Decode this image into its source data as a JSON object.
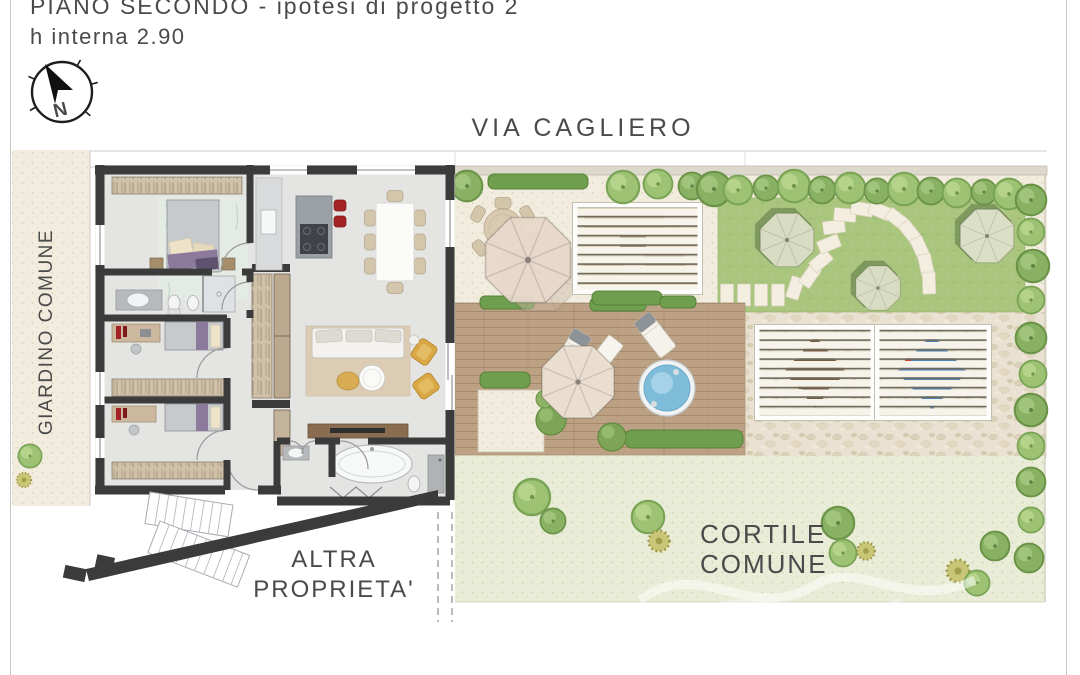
{
  "header": {
    "title": "PIANO SECONDO - ipotesi di progetto 2",
    "subtitle": "h interna 2.90"
  },
  "compass": {
    "north_label": "N"
  },
  "labels": {
    "street": "VIA CAGLIERO",
    "common_garden": "GIARDINO COMUNE",
    "other_property": [
      "ALTRA",
      "PROPRIETA'"
    ],
    "common_courtyard": [
      "CORTILE",
      "COMUNE"
    ]
  },
  "colors": {
    "wall": "#3b3b3b",
    "floor": "#e4e4e2",
    "deck_wood": "#bda184",
    "lawn_green": "#a9c57e",
    "fine_gravel": "#f1ecde",
    "coarse_stone": "#e9e2d2",
    "courtyard_green": "#e9ecd7",
    "hedge_green": "#6f9e4f",
    "tree_green": "#9dc274",
    "pool_water": "#7fbcd9",
    "armchair_yellow": "#d9a844",
    "stool_red": "#a32226",
    "sun_sail_brown": "#7a5a3c",
    "sun_sail_blue": "#4e81b4",
    "text": "#4a4a4a"
  }
}
